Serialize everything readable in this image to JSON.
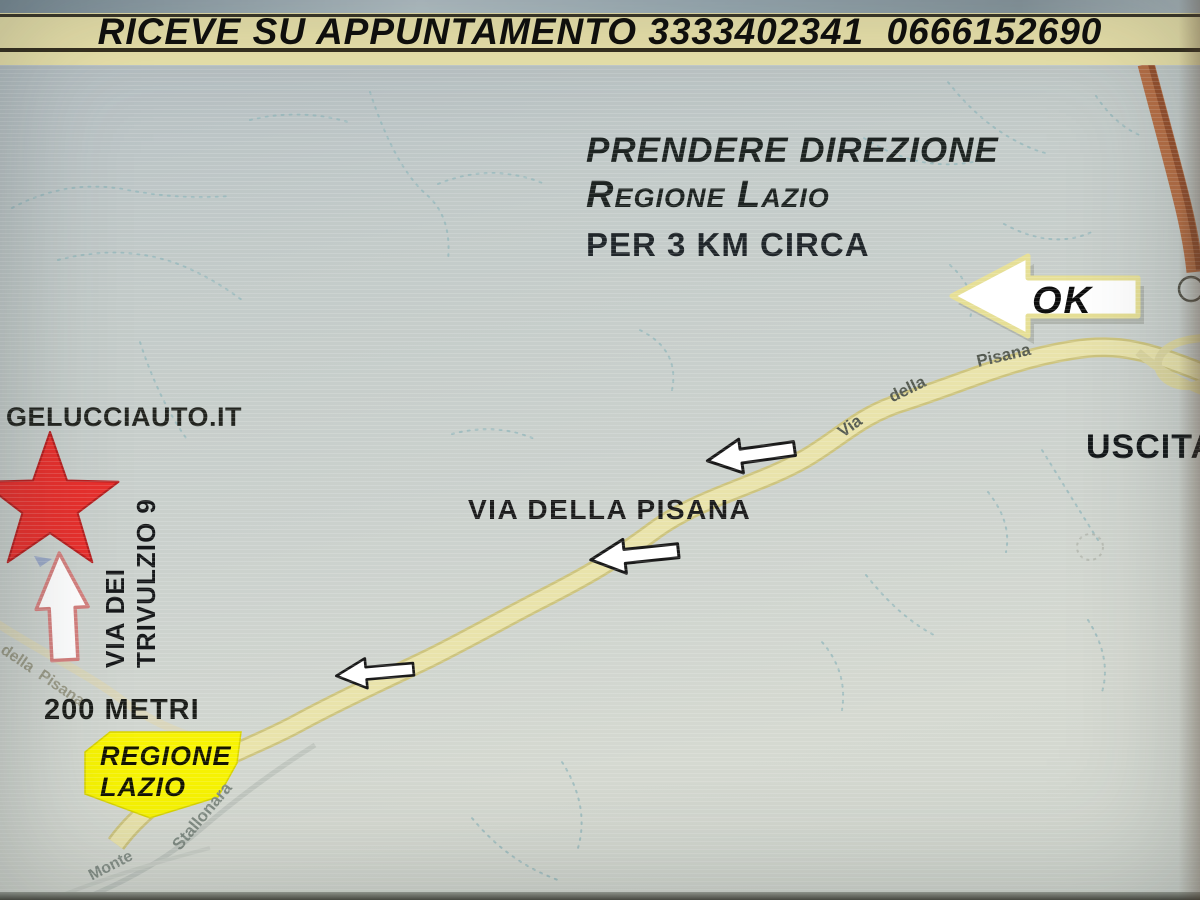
{
  "banner": {
    "text": "RICEVE SU APPUNTAMENTO 3333402341  0666152690"
  },
  "map": {
    "instructions": {
      "line1": "PRENDERE DIREZIONE",
      "line2": "Regione Lazio",
      "line3": "PER 3 KM CIRCA"
    },
    "ok_arrow_label": "OK",
    "exit_label": "USCITA",
    "site_label": "GELUCCIAUTO.IT",
    "street_label": {
      "line1": "VIA DEI",
      "line2": "TRIVULZIO 9"
    },
    "distance_label": "200 METRI",
    "badge": {
      "line1": "REGIONE",
      "line2": "LAZIO"
    },
    "main_road_caption": "VIA DELLA PISANA",
    "road_names": {
      "top_segment": [
        "Via",
        "della",
        "Pisana"
      ],
      "left_segment": "della  Pisana",
      "stallonara": "Stallonara",
      "monte": "Monte"
    },
    "colors": {
      "road_yellow": "#e9e3ab",
      "road_casing": "#cdc47e",
      "road_orange": "#b76f45",
      "road_orange_dark": "#96502d",
      "star_red": "#e8302d",
      "badge_yellow": "#f7f303",
      "contour_teal": "#93b7bb"
    }
  }
}
